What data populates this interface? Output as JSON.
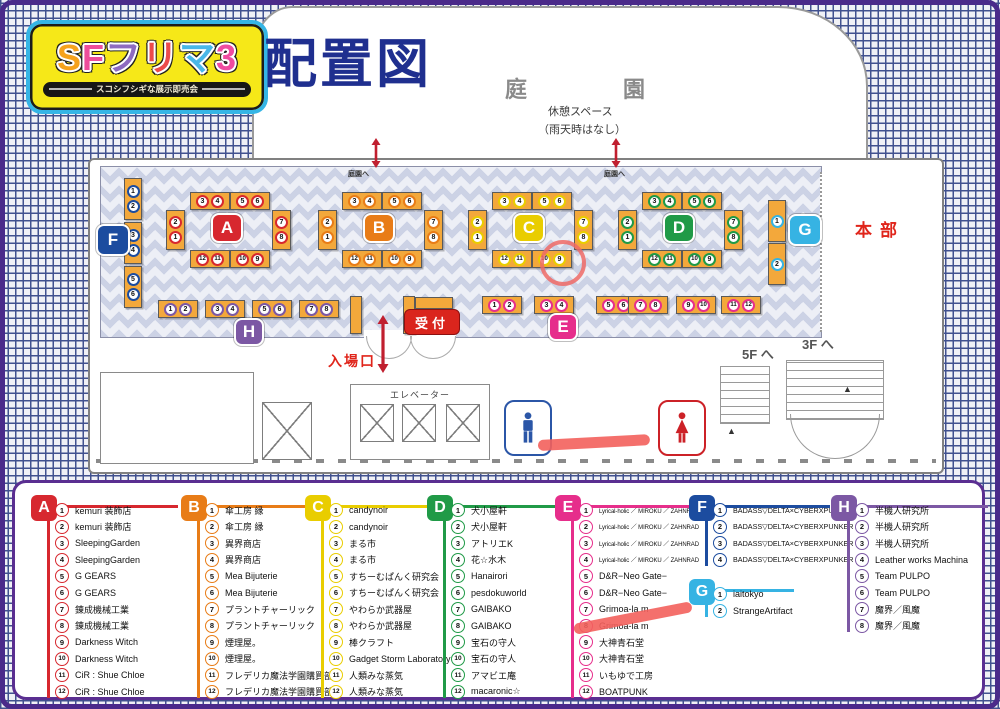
{
  "logo": {
    "main": "SFフリマ3",
    "letter_colors": [
      "#f6a21c",
      "#ee4d9b",
      "#8e6bc0",
      "#ec4b4b",
      "#49b7e8",
      "#ef4ba0"
    ],
    "sub": "スコシフシギな展示即売会",
    "heading": "配置図"
  },
  "map": {
    "garden_left": "庭",
    "garden_right": "園",
    "rest_space": "休憩スペース",
    "rain_note": "（雨天時はなし）",
    "to_garden": "庭園へ",
    "honbu": "本部",
    "reception": "受付",
    "entrance": "入場口",
    "elevator": "エレベーター",
    "stairs_5f": "5F へ",
    "stairs_3f": "3F へ",
    "island_ids": [
      "A",
      "B",
      "C",
      "D"
    ],
    "island_layout": {
      "top": [
        "3",
        "4",
        "5",
        "6"
      ],
      "left": [
        "2",
        "1"
      ],
      "right": [
        "7",
        "8"
      ],
      "bottom": [
        "12",
        "11",
        "10",
        "9"
      ]
    },
    "e_row": [
      "1",
      "2",
      "3",
      "4",
      "5",
      "6",
      "7",
      "8",
      "9",
      "10",
      "11",
      "12"
    ],
    "f_col": [
      "1",
      "2",
      "3",
      "4",
      "5",
      "6"
    ],
    "g_col": [
      "1",
      "2"
    ],
    "h_row": [
      "1",
      "2",
      "3",
      "4",
      "5",
      "6",
      "7",
      "8"
    ],
    "floor_color": "#ccd2e5",
    "booth_color": "#f3a83b",
    "marker_color": "#f3605c"
  },
  "sections": [
    {
      "id": "A",
      "color": "#d7282f",
      "legend": [
        "kemuri 装飾店",
        "kemuri 装飾店",
        "SleepingGarden",
        "SleepingGarden",
        "G GEARS",
        "G GEARS",
        "錬成機械工業",
        "錬成機械工業",
        "Darkness Witch",
        "Darkness Witch",
        "CiR : Shue Chloe",
        "CiR : Shue Chloe"
      ]
    },
    {
      "id": "B",
      "color": "#e87c17",
      "legend": [
        "傘工房 縁",
        "傘工房 縁",
        "異界商店",
        "異界商店",
        "Mea Bijuterie",
        "Mea Bijuterie",
        "プラントチャーリック",
        "プラントチャーリック",
        "煙理屋。",
        "煙理屋。",
        "フレデリカ魔法学園購買部",
        "フレデリカ魔法学園購買部"
      ]
    },
    {
      "id": "C",
      "color": "#e9cd00",
      "legend": [
        "candynoir",
        "candynoir",
        "まる市",
        "まる市",
        "すちーむぱんく研究会",
        "すちーむぱんく研究会",
        "やわらか武器屋",
        "やわらか武器屋",
        "棒クラフト",
        "Gadget Storm Laboratory",
        "人類みな蒸気",
        "人類みな蒸気"
      ]
    },
    {
      "id": "D",
      "color": "#209a47",
      "legend": [
        "犬小屋軒",
        "犬小屋軒",
        "アトリエK",
        "花☆水木",
        "Hanairori",
        "pesdokuworld",
        "GAIBAKO",
        "GAIBAKO",
        "宝石の守人",
        "宝石の守人",
        "アマビエ庵",
        "macaronic☆"
      ]
    },
    {
      "id": "E",
      "color": "#e62e8b",
      "small_items": [
        0,
        1,
        2,
        3
      ],
      "legend": [
        "Lyrical-holic ／ MIROKU ／ ZAHNRAD",
        "Lyrical-holic ／ MIROKU ／ ZAHNRAD",
        "Lyrical-holic ／ MIROKU ／ ZAHNRAD",
        "Lyrical-holic ／ MIROKU ／ ZAHNRAD",
        "D&R−Neo Gate−",
        "D&R−Neo Gate−",
        "Grimoa-la m",
        "Grimoa-la m",
        "大神青石堂",
        "大神青石堂",
        "いもゆで工房",
        "BOATPUNK"
      ]
    },
    {
      "id": "F",
      "color": "#1c4c9f",
      "medium_font": true,
      "legend": [
        "BADASS▽DELTA×CYBERXPUNKER",
        "BADASS▽DELTA×CYBERXPUNKER",
        "BADASS▽DELTA×CYBERXPUNKER",
        "BADASS▽DELTA×CYBERXPUNKER"
      ]
    },
    {
      "id": "G",
      "color": "#36b3e3",
      "legend": [
        "iaitokyo",
        "StrangeArtifact"
      ]
    },
    {
      "id": "H",
      "color": "#7c58a4",
      "legend": [
        "半機人研究所",
        "半機人研究所",
        "半機人研究所",
        "Leather works Machina",
        "Team PULPO",
        "Team PULPO",
        "魔界／風魔",
        "魔界／風魔"
      ]
    }
  ]
}
